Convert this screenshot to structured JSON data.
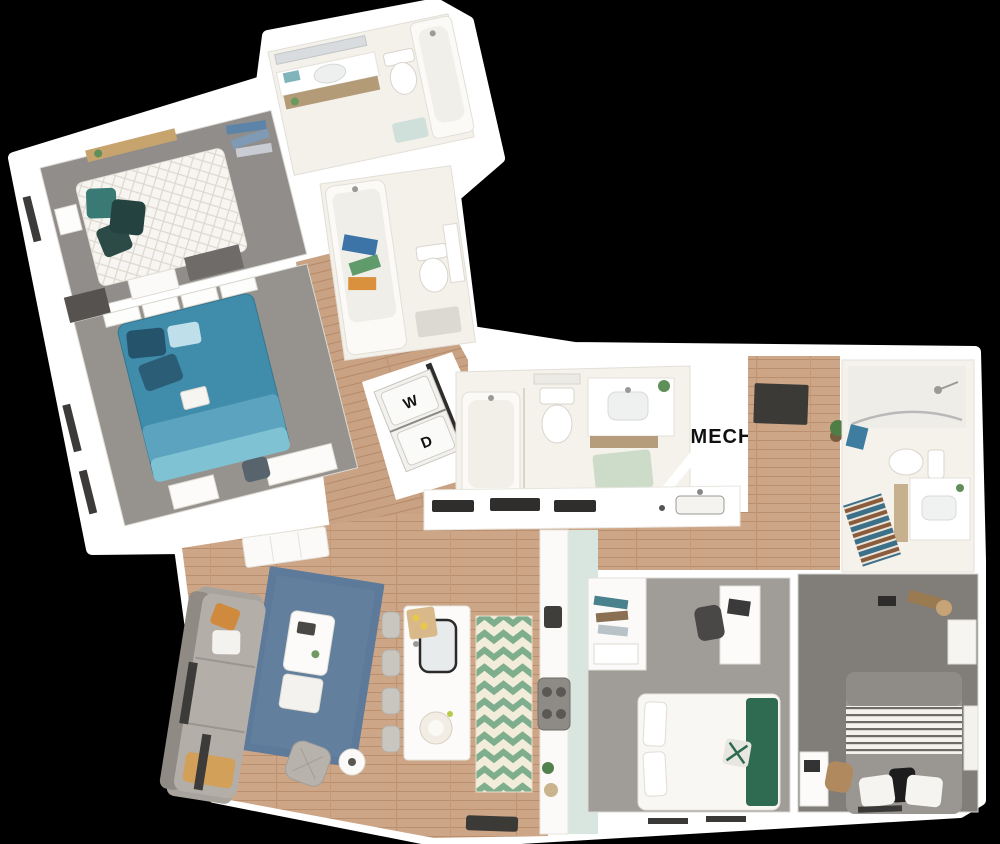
{
  "scene": {
    "type": "3d-floor-plan-render",
    "background": "#000000"
  },
  "labels": {
    "washer": "W",
    "dryer": "D",
    "mechanical_room": "MECH"
  },
  "palette": {
    "walls": "#ffffff",
    "bathroom_floor": "#f4f1ea",
    "carpet_gray": "#94918d",
    "carpet_dark": "#817e7a",
    "wood_floor": "#cda687",
    "bed_teal": "#3f8cab",
    "pillow_teal": "#3a7a74",
    "throw_green": "#2e6b50",
    "rug_blue": "#5d7a9b",
    "chevron_green": "#7fae8e",
    "cabinet_mint": "#d9e6df",
    "stripe_blue": "#3c6f88",
    "stripe_brown": "#8a5c3b",
    "door_mat": "#3b3a37",
    "label_text": "#111111"
  }
}
